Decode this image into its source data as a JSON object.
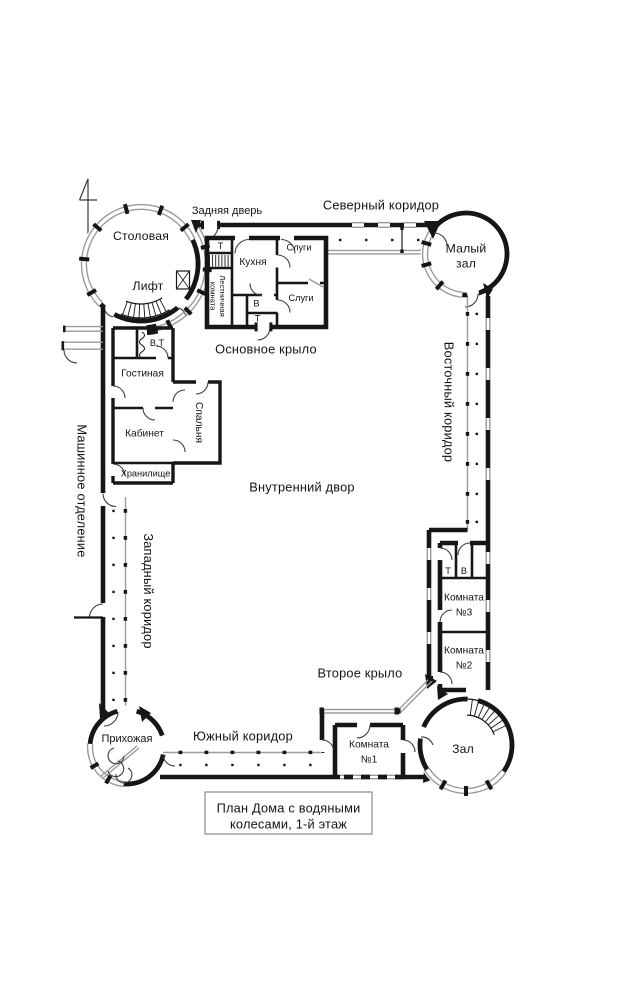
{
  "plan": {
    "rotundas": {
      "dining": "Столовая",
      "lift": "Лифт",
      "small_hall_l1": "Малый",
      "small_hall_l2": "зал",
      "entry": "Прихожая",
      "hall": "Зал"
    },
    "corridors": {
      "north": "Северный коридор",
      "east": "Восточный коридор",
      "south": "Южный коридор",
      "west": "Западный коридор"
    },
    "areas": {
      "main_wing": "Основное крыло",
      "second_wing": "Второе крыло",
      "courtyard": "Внутренний двор",
      "machine": "Машинное отделение",
      "back_door": "Задняя дверь"
    },
    "main_wing": {
      "t": "Т",
      "stair_l1": "Лестничная",
      "stair_l2": "комната",
      "kitchen": "Кухня",
      "servants_top": "Слуги",
      "servants_bottom": "Слуги",
      "b": "В",
      "t2": "Т"
    },
    "west_wing": {
      "wt": "В.Т",
      "living": "Гостиная",
      "bedroom": "Спальня",
      "office": "Кабинет",
      "storage": "Хранилище"
    },
    "east_wing": {
      "t": "Т",
      "b": "В",
      "room3_l1": "Комната",
      "room3_l2": "№3",
      "room2_l1": "Комната",
      "room2_l2": "№2"
    },
    "south_wing": {
      "room1_l1": "Комната",
      "room1_l2": "№1"
    },
    "title": {
      "l1": "План Дома с водяными",
      "l2": "колесами, 1-й этаж"
    }
  }
}
